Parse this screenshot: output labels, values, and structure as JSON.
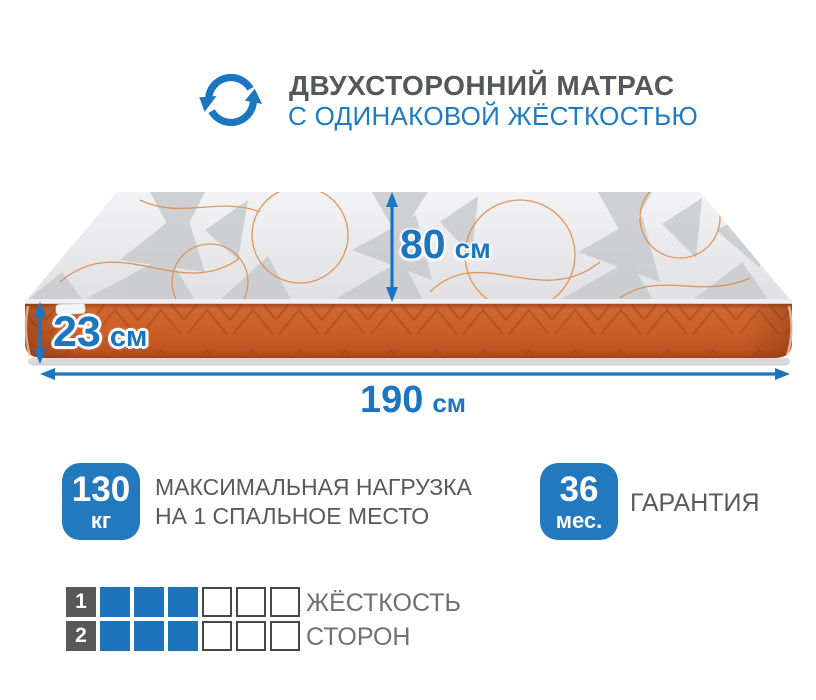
{
  "header": {
    "title": "ДВУХСТОРОННИЙ МАТРАС",
    "subtitle": "С ОДИНАКОВОЙ ЖЁСТКОСТЬЮ",
    "icon": "rotate-arrows-icon"
  },
  "dimensions": {
    "width": {
      "value": "80",
      "unit": "см"
    },
    "height": {
      "value": "23",
      "unit": "см"
    },
    "length": {
      "value": "190",
      "unit": "см"
    }
  },
  "features": {
    "max_load": {
      "value": "130",
      "unit": "кг",
      "label_line1": "МАКСИМАЛЬНАЯ НАГРУЗКА",
      "label_line2": "НА 1 СПАЛЬНОЕ МЕСТО"
    },
    "warranty": {
      "value": "36",
      "unit": "мес.",
      "label": "ГАРАНТИЯ"
    }
  },
  "firmness": {
    "label_line1": "ЖЁСТКОСТЬ",
    "label_line2": "СТОРОН",
    "scale_total": 6,
    "rows": [
      {
        "number": "1",
        "filled": 3,
        "empty": 3
      },
      {
        "number": "2",
        "filled": 3,
        "empty": 3
      }
    ]
  },
  "colors": {
    "accent_blue": "#1b76bf",
    "badge_blue": "#2379bd",
    "square_blue": "#1e74ba",
    "text_gray": "#58595b",
    "title_gray": "#56575a",
    "mattress_orange": "#c95d28",
    "mattress_top_gray": "#e9e9eb"
  }
}
